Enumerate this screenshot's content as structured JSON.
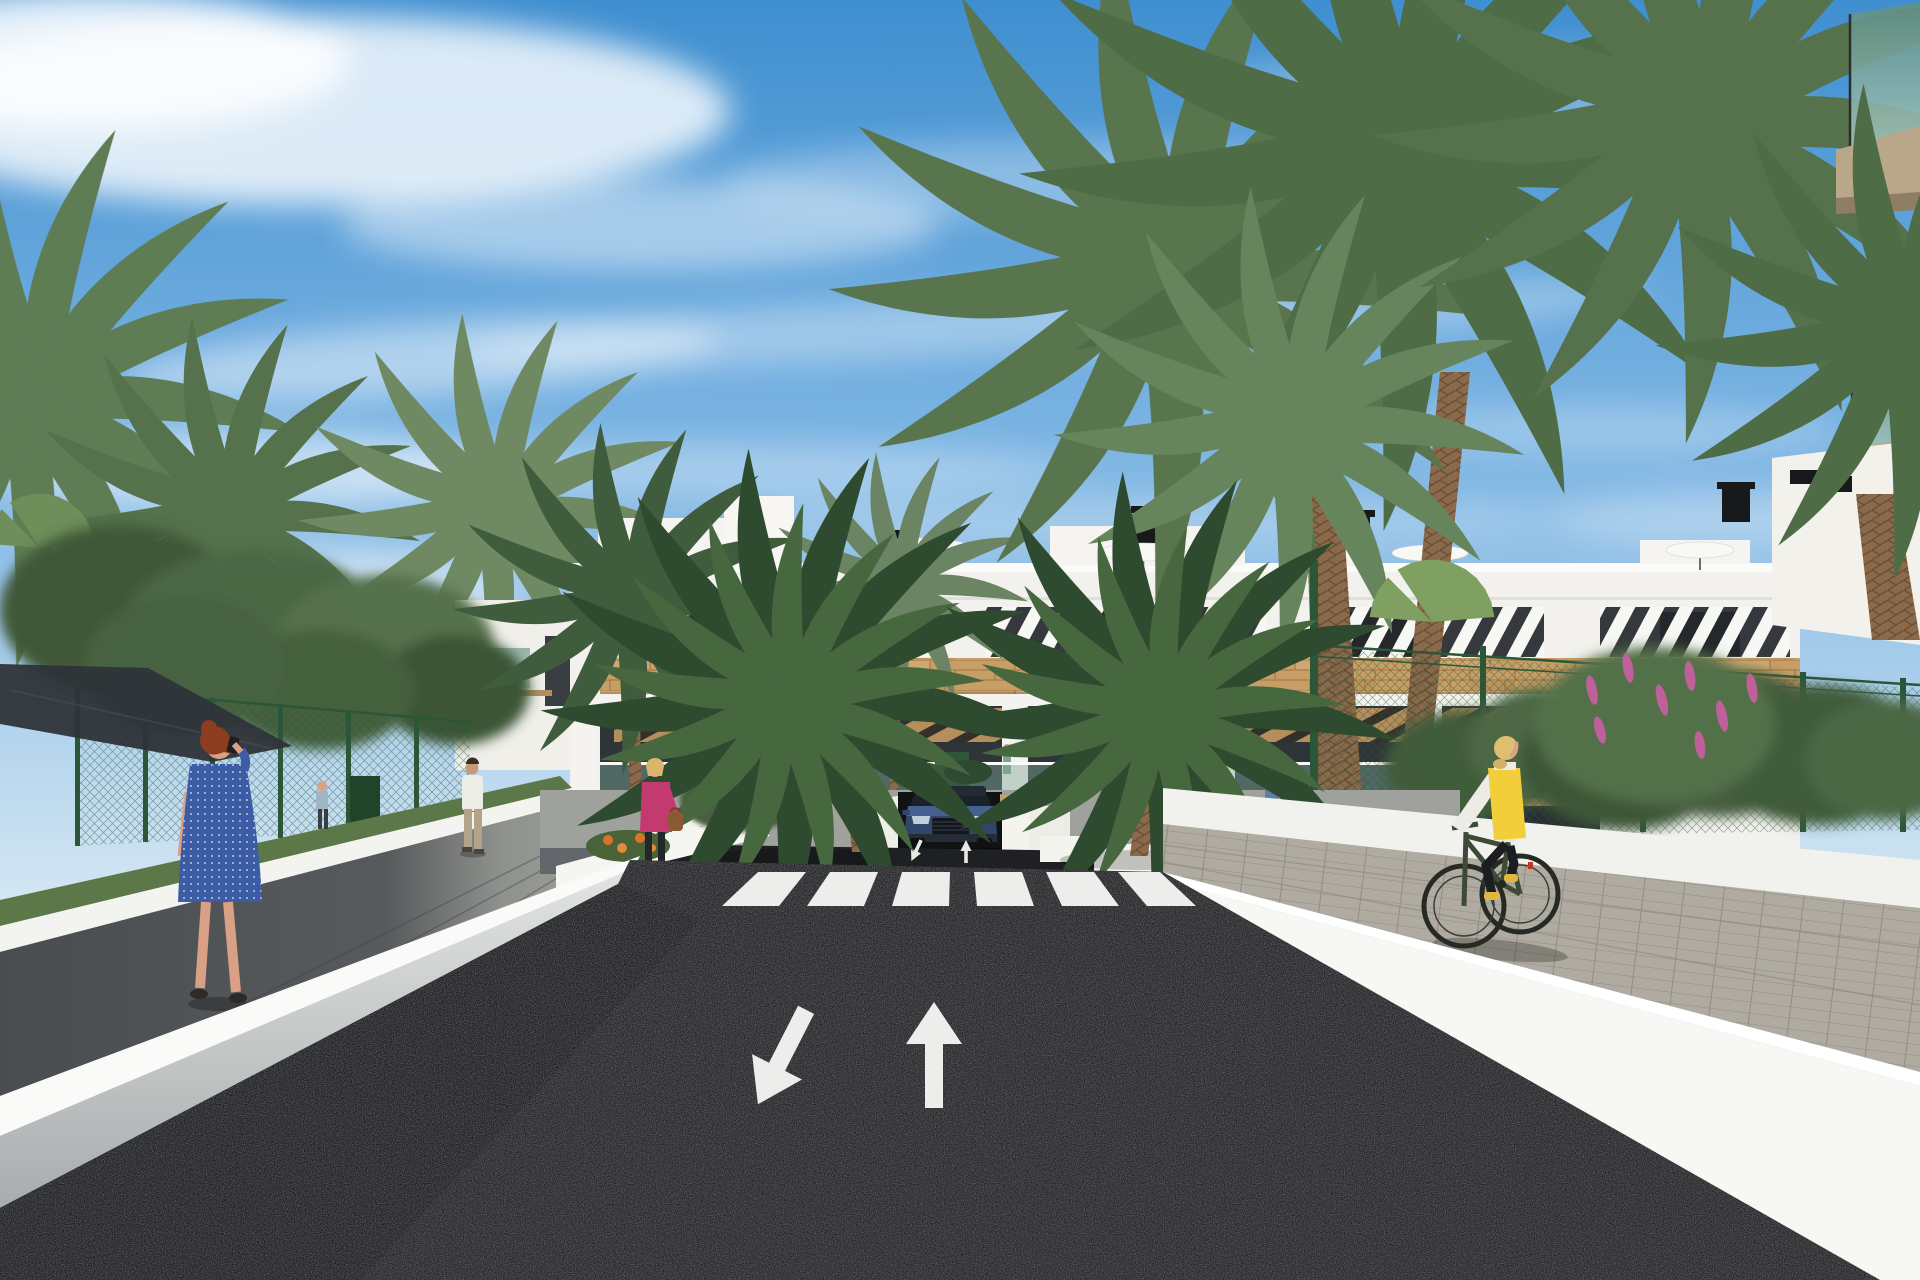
{
  "scene": {
    "type": "3d-architectural-rendering",
    "title": "Residential complex street view",
    "description": "Photorealistic render of a modern white apartment building with wood cladding and louver shading, palm trees, an access road with crosswalk, lane arrows, underground garage ramp with emerging SUV, pedestrians and a cyclist",
    "objects": [
      "sky-with-cirrus-clouds",
      "main-apartment-building",
      "left-wing-building",
      "right-foreground-building",
      "palm-trees",
      "leafy-trees",
      "shade-sail",
      "green-mesh-fence",
      "white-retaining-walls",
      "asphalt-road",
      "zebra-crosswalk",
      "lane-arrows",
      "garage-ramp",
      "blue-suv",
      "pedestrian-woman-on-phone",
      "pedestrian-man",
      "pedestrian-woman-pink-jacket",
      "pedestrians-near-entrance",
      "cyclist-yellow-vest",
      "bike-racks",
      "flower-beds"
    ]
  },
  "road": {
    "crosswalk_stripe_count": 6,
    "lane_arrow_left": "oncoming-toward-viewer",
    "lane_arrow_right": "forward-away-from-viewer"
  },
  "colors": {
    "sky_top": "#3F8FD0",
    "sky_mid": "#7DB5E3",
    "sky_horizon": "#D3E6F3",
    "cloud": "#FFFFFF",
    "building_white": "#F2F1ED",
    "window_dark": "#35393D",
    "wood": "#C79F66",
    "glass_teal": "#7FA89C",
    "road_asphalt": "#232428",
    "marking_white": "#EDEDEB",
    "wall_bright": "#F7F7F4",
    "walkway_dark": "#55585A",
    "cycle_path": "#AFABA1",
    "fence_green": "#2B5638",
    "foliage_dark": "#3E5A38",
    "foliage_mid": "#52704A",
    "palm_green": "#4E7046",
    "palm_trunk": "#8A6A4B",
    "flower_pink": "#C0609A",
    "flower_orange": "#D9732A",
    "shade_sail": "#2E3338",
    "car_blue": "#45618F",
    "car_blue_dark": "#32466B",
    "dress_blue": "#3D5CA6",
    "jacket_pink": "#C23A70",
    "vest_yellow": "#F2CE3A",
    "skin": "#D9A086",
    "hair_red": "#8C3D20",
    "hair_blonde": "#D9B66B"
  }
}
